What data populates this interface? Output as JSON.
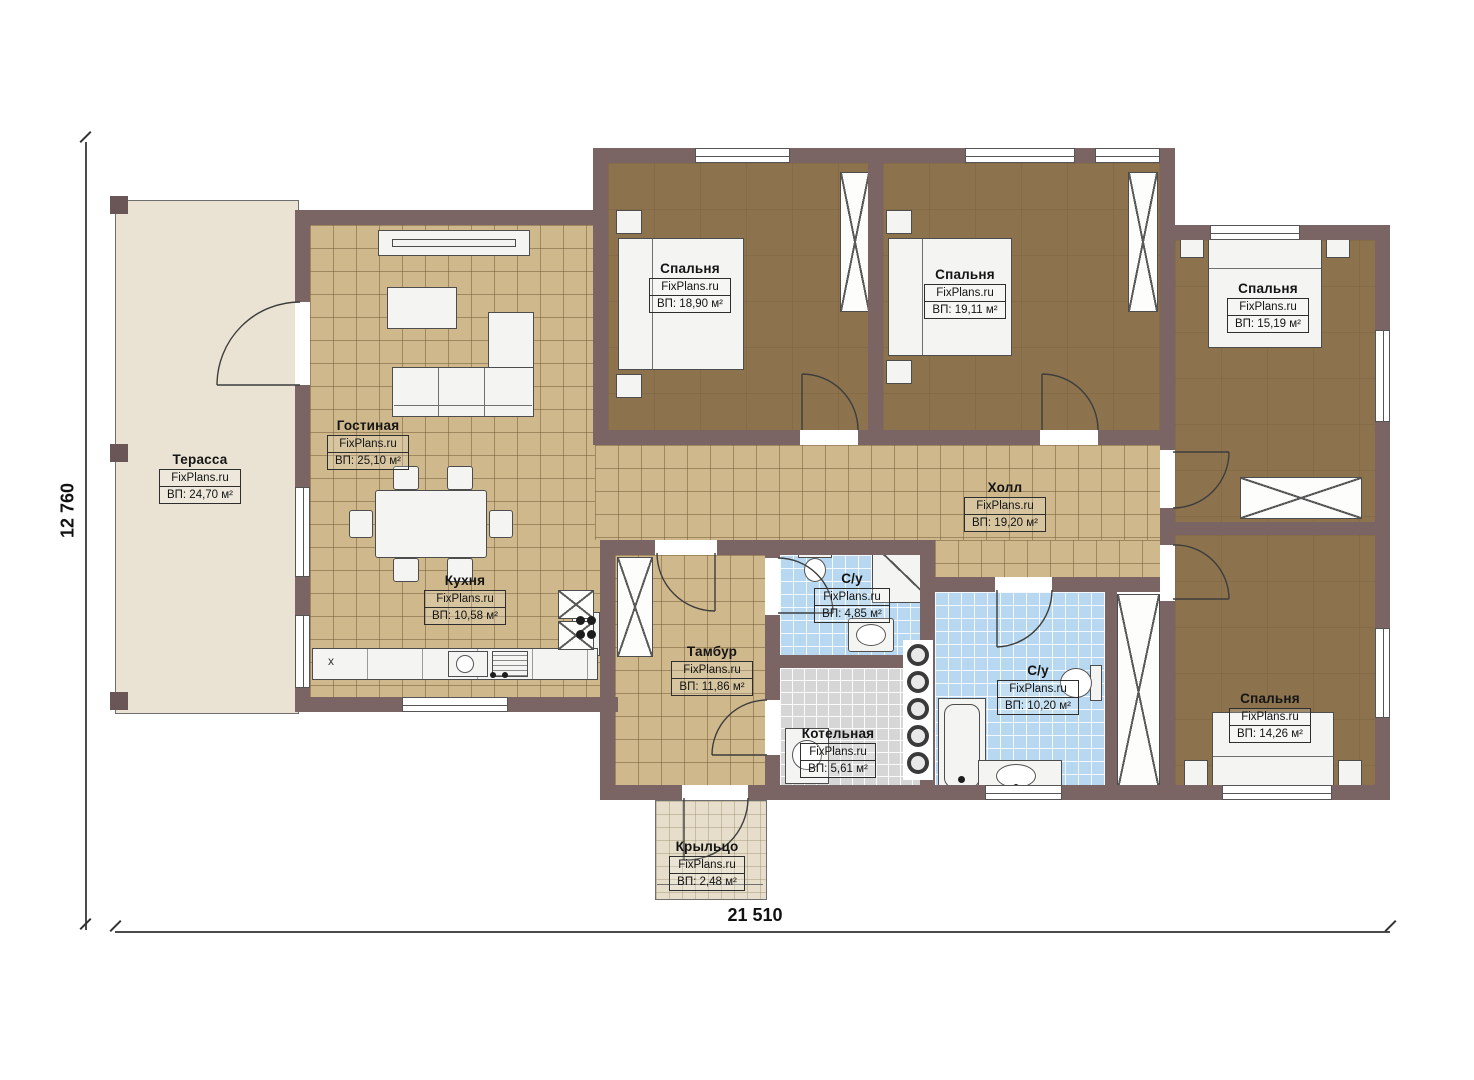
{
  "watermark": "FixPlans.ru",
  "dimensions": {
    "width": "21 510",
    "height": "12 760"
  },
  "kitchen_counter_mark": "x",
  "rooms": [
    {
      "id": "terrace",
      "name": "Терасса",
      "area": "ВП: 24,70 м²"
    },
    {
      "id": "living",
      "name": "Гостиная",
      "area": "ВП: 25,10 м²"
    },
    {
      "id": "kitchen",
      "name": "Кухня",
      "area": "ВП: 10,58 м²"
    },
    {
      "id": "bedroom-1",
      "name": "Спальня",
      "area": "ВП: 18,90 м²"
    },
    {
      "id": "bedroom-2",
      "name": "Спальня",
      "area": "ВП: 19,11 м²"
    },
    {
      "id": "bedroom-3",
      "name": "Спальня",
      "area": "ВП: 15,19 м²"
    },
    {
      "id": "hall",
      "name": "Холл",
      "area": "ВП: 19,20 м²"
    },
    {
      "id": "wc-1",
      "name": "С/у",
      "area": "ВП: 4,85 м²"
    },
    {
      "id": "tambur",
      "name": "Тамбур",
      "area": "ВП: 11,86 м²"
    },
    {
      "id": "boiler",
      "name": "Котельная",
      "area": "ВП: 5,61 м²"
    },
    {
      "id": "wc-2",
      "name": "С/у",
      "area": "ВП: 10,20 м²"
    },
    {
      "id": "bedroom-4",
      "name": "Спальня",
      "area": "ВП: 14,26 м²"
    },
    {
      "id": "porch",
      "name": "Крыльцо",
      "area": "ВП: 2,48 м²"
    }
  ],
  "colors": {
    "wall": "#7a6464",
    "floor_tile_beige": "#cfb98c",
    "floor_bedroom_brown": "#8c734e",
    "floor_bathroom_blue": "#b7d8f0",
    "floor_boiler_grey": "#d6d6d6",
    "floor_terrace": "#eae3d3"
  }
}
